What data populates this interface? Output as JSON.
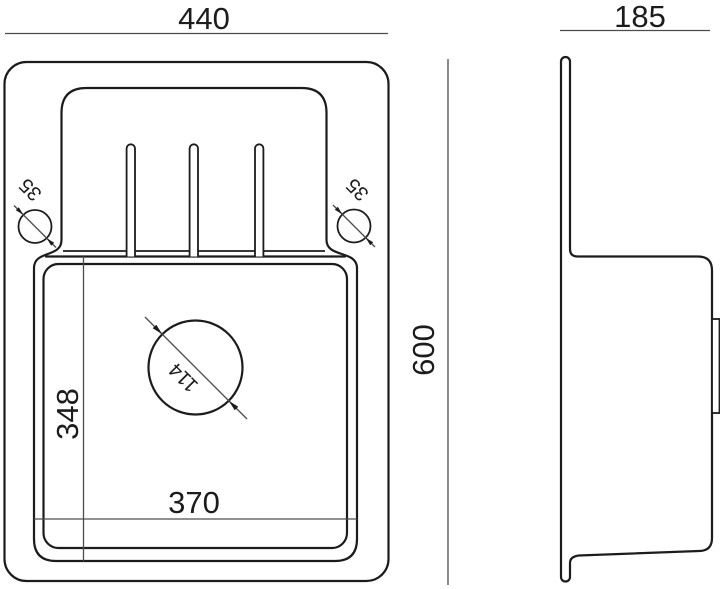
{
  "drawing": {
    "kind": "sink-dimension-drawing",
    "colors": {
      "outline": "#1c1c1c",
      "dimension_line": "#4d4d4d",
      "background": "#ffffff"
    },
    "views": {
      "top_view": {
        "name": "top-view",
        "dimensions": {
          "overall_width": "440",
          "overall_length": "600",
          "bowl_width": "370",
          "bowl_length": "348",
          "drain_hole_diameter": "114",
          "tap_hole_left_diameter": "35",
          "tap_hole_right_diameter": "35"
        }
      },
      "side_view": {
        "name": "side-view",
        "dimensions": {
          "overall_height": "185"
        }
      }
    }
  }
}
